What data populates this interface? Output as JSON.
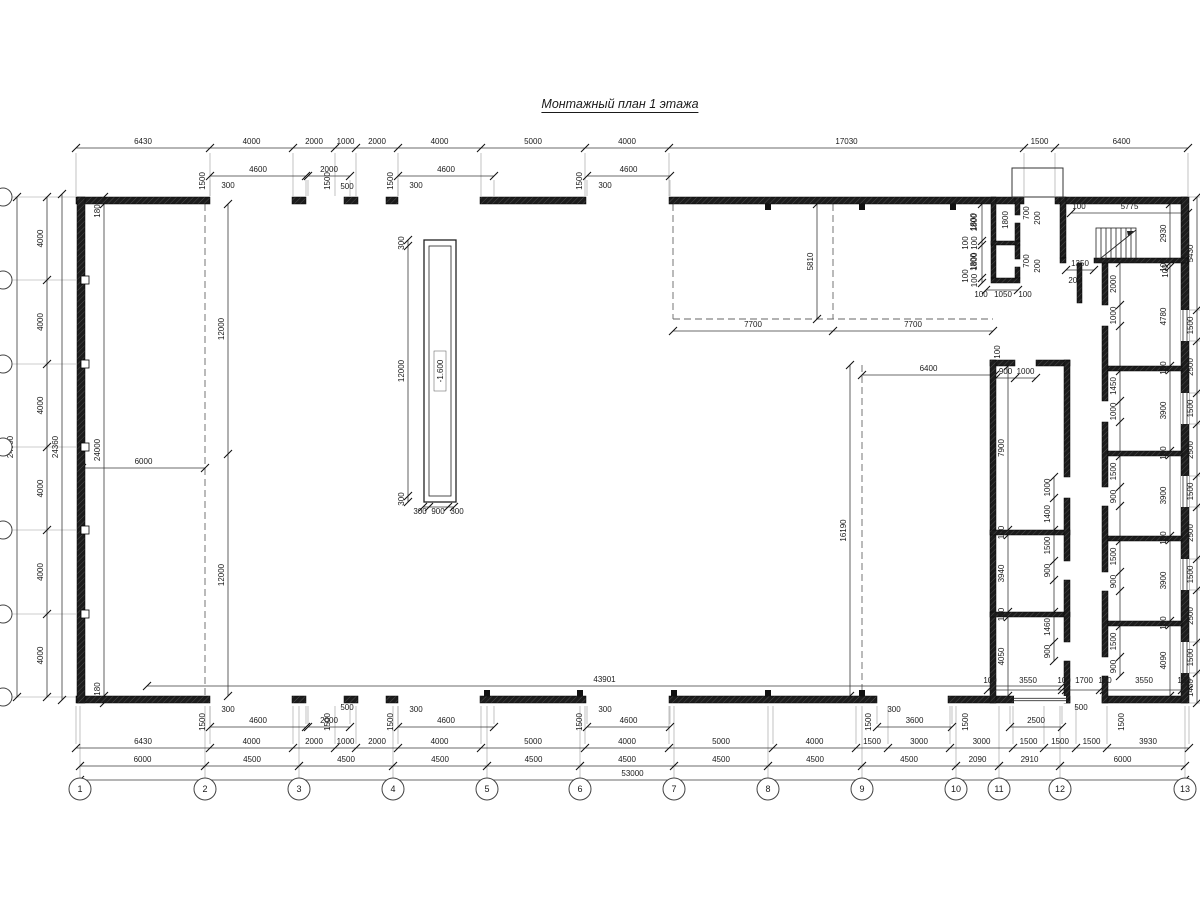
{
  "title": "Монтажный план 1 этажа",
  "plan": {
    "colors": {
      "wall": "#1c1c1c",
      "wallHatch": "#4d4d4d",
      "dim": "#3a3a3a",
      "ext": "#9a9a9a",
      "dash": "#666666",
      "text": "#1a1a1a",
      "window": "#333333"
    },
    "axes_bottom": {
      "labels": [
        "1",
        "2",
        "3",
        "4",
        "5",
        "6",
        "7",
        "8",
        "9",
        "10",
        "11",
        "12",
        "13"
      ],
      "x": [
        80,
        205,
        299,
        393,
        487,
        580,
        674,
        768,
        862,
        956,
        999,
        1060,
        1185
      ],
      "cy": 789,
      "r": 11
    },
    "axes_left": {
      "cy": [
        197,
        280,
        364,
        447,
        530,
        614,
        697
      ],
      "cx": 3,
      "r": 9
    },
    "chains": [
      {
        "d": "h",
        "p": 148,
        "o": -4,
        "t": [
          76,
          210,
          293,
          335,
          356,
          398,
          481,
          585,
          669,
          1024,
          1055,
          1188
        ],
        "v": [
          "6430",
          "4000",
          "2000",
          "1000",
          "2000",
          "4000",
          "5000",
          "4000",
          "17030",
          "1500",
          "6400"
        ],
        "ext": [
          153,
          196
        ]
      },
      {
        "d": "h",
        "p": 176,
        "t": [
          210,
          306
        ],
        "v": [
          "4600"
        ],
        "ext": [
          180,
          196
        ]
      },
      {
        "d": "h",
        "p": 176,
        "t": [
          308,
          350
        ],
        "v": [
          "2000"
        ],
        "ext": [
          180,
          196
        ]
      },
      {
        "d": "h",
        "p": 176,
        "t": [
          398,
          494
        ],
        "v": [
          "4600"
        ],
        "ext": [
          180,
          196
        ]
      },
      {
        "d": "h",
        "p": 176,
        "t": [
          587,
          670
        ],
        "v": [
          "4600"
        ],
        "ext": [
          180,
          196
        ]
      },
      {
        "d": "h",
        "p": 748,
        "o": -4,
        "t": [
          76,
          210,
          293,
          335,
          356,
          398,
          481,
          585,
          669,
          773,
          856,
          888,
          950,
          1013,
          1044,
          1076,
          1107,
          1189
        ],
        "v": [
          "6430",
          "4000",
          "2000",
          "1000",
          "2000",
          "4000",
          "5000",
          "4000",
          "5000",
          "4000",
          "1500",
          "3000",
          "3000",
          "1500",
          "1500",
          "1500",
          "3930"
        ],
        "ext": [
          706,
          744
        ]
      },
      {
        "d": "h",
        "p": 766,
        "t": [
          80,
          205,
          299,
          393,
          487,
          580,
          674,
          768,
          862,
          956,
          999,
          1060,
          1185
        ],
        "v": [
          "6000",
          "4500",
          "4500",
          "4500",
          "4500",
          "4500",
          "4500",
          "4500",
          "4500",
          "2090",
          "2910",
          "6000"
        ]
      },
      {
        "d": "h",
        "p": 780,
        "t": [
          80,
          1185
        ],
        "v": [
          "53000"
        ]
      },
      {
        "d": "h",
        "p": 727,
        "t": [
          210,
          306
        ],
        "v": [
          "4600"
        ],
        "ext": [
          706,
          724
        ]
      },
      {
        "d": "h",
        "p": 727,
        "t": [
          308,
          350
        ],
        "v": [
          "2000"
        ],
        "ext": [
          706,
          724
        ]
      },
      {
        "d": "h",
        "p": 727,
        "t": [
          398,
          494
        ],
        "v": [
          "4600"
        ],
        "ext": [
          706,
          724
        ]
      },
      {
        "d": "h",
        "p": 727,
        "t": [
          587,
          670
        ],
        "v": [
          "4600"
        ],
        "ext": [
          706,
          724
        ]
      },
      {
        "d": "h",
        "p": 727,
        "t": [
          877,
          952
        ],
        "v": [
          "3600"
        ],
        "ext": [
          706,
          724
        ]
      },
      {
        "d": "h",
        "p": 727,
        "t": [
          1010,
          1062
        ],
        "v": [
          "2500"
        ],
        "ext": [
          706,
          724
        ]
      },
      {
        "d": "h",
        "p": 686,
        "t": [
          147,
          1062
        ],
        "v": [
          "43901"
        ]
      },
      {
        "d": "h",
        "p": 690,
        "t": [
          988,
          1062,
          1066,
          1100,
          1104,
          1182,
          1188
        ],
        "v": []
      },
      {
        "d": "h",
        "p": 468,
        "t": [
          82,
          205
        ],
        "v": [
          "6000"
        ]
      },
      {
        "d": "h",
        "p": 331,
        "t": [
          673,
          833,
          993
        ],
        "v": [
          "7700",
          "7700"
        ]
      },
      {
        "d": "h",
        "p": 375,
        "t": [
          862,
          995
        ],
        "v": [
          "6400"
        ]
      },
      {
        "d": "h",
        "p": 290,
        "t": [
          986,
          1018
        ],
        "v": []
      },
      {
        "d": "h",
        "p": 213,
        "o": -4,
        "t": [
          1071,
          1188
        ],
        "v": [
          "5775"
        ]
      },
      {
        "d": "h",
        "p": 270,
        "o": -4,
        "t": [
          1066,
          1094
        ],
        "v": [
          "1350"
        ]
      },
      {
        "d": "h",
        "p": 378,
        "o": -4,
        "t": [
          996,
          1015,
          1036
        ],
        "v": [
          "900",
          "1000"
        ]
      },
      {
        "d": "h",
        "p": 507,
        "t": [
          423,
          429,
          448,
          454
        ],
        "v": []
      },
      {
        "d": "v",
        "p": 47,
        "o": -4,
        "t": [
          197,
          280,
          364,
          447,
          530,
          614,
          697
        ],
        "v": [
          "4000",
          "4000",
          "4000",
          "4000",
          "4000",
          "4000"
        ]
      },
      {
        "d": "v",
        "p": 17,
        "o": -4,
        "t": [
          197,
          697
        ],
        "v": [
          "24000"
        ]
      },
      {
        "d": "v",
        "p": 62,
        "o": -4,
        "t": [
          194,
          700
        ],
        "v": [
          "24360"
        ]
      },
      {
        "d": "v",
        "p": 104,
        "o": -4,
        "t": [
          197,
          204,
          696,
          703
        ],
        "v": [
          "",
          "24000",
          ""
        ]
      },
      {
        "d": "v",
        "p": 1197,
        "o": -4,
        "t": [
          197,
          310,
          341,
          393,
          424,
          476,
          507,
          559,
          590,
          642,
          673,
          703
        ],
        "v": [
          "5430",
          "1500",
          "2500",
          "1500",
          "2500",
          "1500",
          "2500",
          "1500",
          "2500",
          "1500",
          "1430"
        ],
        "ext": [
          1189,
          1200
        ]
      },
      {
        "d": "v",
        "p": 1170,
        "o": -4,
        "t": [
          204,
          263,
          267,
          366,
          370,
          451,
          455,
          536,
          540,
          621,
          625,
          696
        ],
        "v": [
          "2930",
          "100",
          "4780",
          "100",
          "3900",
          "100",
          "3900",
          "100",
          "3900",
          "100",
          "4090"
        ]
      },
      {
        "d": "v",
        "p": 1008,
        "o": -4,
        "t": [
          366,
          530,
          535,
          612,
          617,
          696
        ],
        "v": [
          "7900",
          "100",
          "3940",
          "100",
          "4050"
        ]
      },
      {
        "d": "v",
        "p": 1054,
        "o": -4,
        "t": [
          477,
          498,
          530,
          561,
          580,
          612,
          642,
          661
        ],
        "v": [
          "1000",
          "1400",
          "1500",
          "900",
          "",
          "1460",
          "900"
        ]
      },
      {
        "d": "v",
        "p": 1120,
        "o": -4,
        "t": [
          263,
          305,
          326,
          371,
          401,
          422,
          456,
          487,
          506,
          541,
          572,
          591,
          626,
          657,
          676
        ],
        "v": [
          "2000",
          "1000",
          "",
          "1450",
          "1000",
          "",
          "1500",
          "900",
          "",
          "1500",
          "900",
          "",
          "1500",
          "900"
        ]
      },
      {
        "d": "v",
        "p": 817,
        "o": -4,
        "t": [
          204,
          319
        ],
        "v": [
          "5810"
        ]
      },
      {
        "d": "v",
        "p": 850,
        "o": -4,
        "t": [
          365,
          696
        ],
        "v": [
          "16190"
        ]
      },
      {
        "d": "v",
        "p": 228,
        "o": -4,
        "t": [
          204,
          454,
          696
        ],
        "v": [
          "12000",
          "12000"
        ]
      },
      {
        "d": "v",
        "p": 408,
        "o": -4,
        "t": [
          240,
          246,
          496,
          502
        ],
        "v": [
          "300",
          "12000",
          "300"
        ]
      },
      {
        "d": "v",
        "p": 982,
        "o": -5,
        "t": [
          204,
          241,
          245,
          278,
          283
        ],
        "v": [
          "1800",
          "100",
          "1800",
          "100"
        ]
      }
    ],
    "labels": [
      [
        "1500",
        205,
        181,
        1
      ],
      [
        "300",
        228,
        188,
        0
      ],
      [
        "1500",
        330,
        181,
        1
      ],
      [
        "500",
        347,
        189,
        0
      ],
      [
        "1500",
        393,
        181,
        1
      ],
      [
        "300",
        416,
        188,
        0
      ],
      [
        "1500",
        582,
        181,
        1
      ],
      [
        "300",
        605,
        188,
        0
      ],
      [
        "1800",
        1008,
        220,
        1
      ],
      [
        "700",
        1029,
        213,
        1
      ],
      [
        "200",
        1040,
        218,
        1
      ],
      [
        "700",
        1029,
        261,
        1
      ],
      [
        "200",
        1040,
        266,
        1
      ],
      [
        "1800",
        976,
        222,
        1
      ],
      [
        "100",
        968,
        243,
        1
      ],
      [
        "1800",
        976,
        262,
        1
      ],
      [
        "100",
        968,
        276,
        1
      ],
      [
        "100",
        981,
        297,
        0
      ],
      [
        "1050",
        1003,
        297,
        0
      ],
      [
        "100",
        1025,
        297,
        0
      ],
      [
        "100",
        1000,
        352,
        1
      ],
      [
        "100",
        1079,
        209,
        0
      ],
      [
        "100",
        1168,
        271,
        1
      ],
      [
        "200",
        1075,
        283,
        0
      ],
      [
        "180",
        100,
        211,
        1
      ],
      [
        "180",
        100,
        689,
        1
      ],
      [
        "1500",
        205,
        722,
        1
      ],
      [
        "300",
        228,
        712,
        0
      ],
      [
        "1500",
        330,
        722,
        1
      ],
      [
        "500",
        347,
        710,
        0
      ],
      [
        "1500",
        393,
        722,
        1
      ],
      [
        "300",
        416,
        712,
        0
      ],
      [
        "1500",
        582,
        722,
        1
      ],
      [
        "300",
        605,
        712,
        0
      ],
      [
        "1500",
        871,
        722,
        1
      ],
      [
        "300",
        894,
        712,
        0
      ],
      [
        "1500",
        968,
        722,
        1
      ],
      [
        "500",
        1081,
        710,
        0
      ],
      [
        "1500",
        1124,
        722,
        1
      ],
      [
        "100",
        990,
        683,
        0
      ],
      [
        "3550",
        1028,
        683,
        0
      ],
      [
        "100",
        1064,
        683,
        0
      ],
      [
        "1700",
        1084,
        683,
        0
      ],
      [
        "100",
        1105,
        683,
        0
      ],
      [
        "3550",
        1144,
        683,
        0
      ],
      [
        "180",
        1184,
        683,
        0
      ],
      [
        "300",
        420,
        514,
        0
      ],
      [
        "900",
        438,
        514,
        0
      ],
      [
        "300",
        457,
        514,
        0
      ]
    ],
    "walls": [
      [
        76,
        197,
        134,
        7
      ],
      [
        292,
        197,
        14,
        7
      ],
      [
        344,
        197,
        14,
        7
      ],
      [
        386,
        197,
        12,
        7
      ],
      [
        480,
        197,
        106,
        7
      ],
      [
        669,
        197,
        355,
        7
      ],
      [
        1055,
        197,
        133,
        7
      ],
      [
        76,
        696,
        134,
        7
      ],
      [
        292,
        696,
        14,
        7
      ],
      [
        344,
        696,
        14,
        7
      ],
      [
        386,
        696,
        12,
        7
      ],
      [
        480,
        696,
        106,
        7
      ],
      [
        669,
        696,
        208,
        7
      ],
      [
        948,
        696,
        66,
        7
      ],
      [
        1066,
        696,
        4,
        7
      ],
      [
        1102,
        696,
        86,
        7
      ],
      [
        77,
        197,
        8,
        506
      ],
      [
        1181,
        197,
        8,
        506
      ],
      [
        991,
        197,
        5,
        81
      ],
      [
        1015,
        197,
        5,
        18
      ],
      [
        1015,
        223,
        5,
        18
      ],
      [
        1015,
        245,
        5,
        14
      ],
      [
        1015,
        267,
        5,
        11
      ],
      [
        991,
        241,
        29,
        4
      ],
      [
        991,
        278,
        29,
        5
      ],
      [
        990,
        360,
        25,
        6
      ],
      [
        1036,
        360,
        34,
        6
      ],
      [
        990,
        360,
        6,
        343
      ],
      [
        990,
        530,
        80,
        5
      ],
      [
        990,
        612,
        80,
        5
      ],
      [
        1064,
        360,
        6,
        117
      ],
      [
        1064,
        498,
        6,
        63
      ],
      [
        1064,
        580,
        6,
        62
      ],
      [
        1064,
        661,
        6,
        42
      ],
      [
        1102,
        263,
        6,
        42
      ],
      [
        1102,
        326,
        6,
        75
      ],
      [
        1102,
        422,
        6,
        65
      ],
      [
        1102,
        506,
        6,
        66
      ],
      [
        1102,
        591,
        6,
        66
      ],
      [
        1102,
        676,
        6,
        27
      ],
      [
        1077,
        263,
        5,
        40
      ],
      [
        1108,
        366,
        74,
        5
      ],
      [
        1108,
        451,
        74,
        5
      ],
      [
        1108,
        536,
        74,
        5
      ],
      [
        1108,
        621,
        74,
        5
      ],
      [
        1060,
        197,
        6,
        61
      ],
      [
        1060,
        258,
        6,
        5
      ],
      [
        1094,
        258,
        94,
        5
      ]
    ],
    "tmarks_top": [
      768,
      862,
      953
    ],
    "tmarks_bottom": [
      487,
      580,
      674,
      768,
      862
    ],
    "pilasters": [
      280,
      364,
      447,
      530,
      614
    ],
    "dashed": [
      [
        205,
        204,
        205,
        696
      ],
      [
        673,
        204,
        673,
        319
      ],
      [
        833,
        204,
        833,
        319
      ],
      [
        862,
        365,
        862,
        696
      ],
      [
        673,
        319,
        993,
        319
      ]
    ],
    "windows_right": {
      "x": 1181,
      "w": 8,
      "h": 31,
      "y": [
        310,
        393,
        476,
        559,
        642
      ]
    },
    "window_bottom": [
      1014,
      696,
      52,
      7
    ],
    "porch": [
      1012,
      168,
      51,
      29
    ],
    "pit": {
      "outer": [
        424,
        240,
        32,
        262
      ],
      "inner": [
        429,
        246,
        22,
        250
      ],
      "label": "-1.600",
      "label_x": 440,
      "label_y": 371
    },
    "stair": {
      "x": 1096,
      "y": 228,
      "w": 40,
      "h": 34
    }
  }
}
